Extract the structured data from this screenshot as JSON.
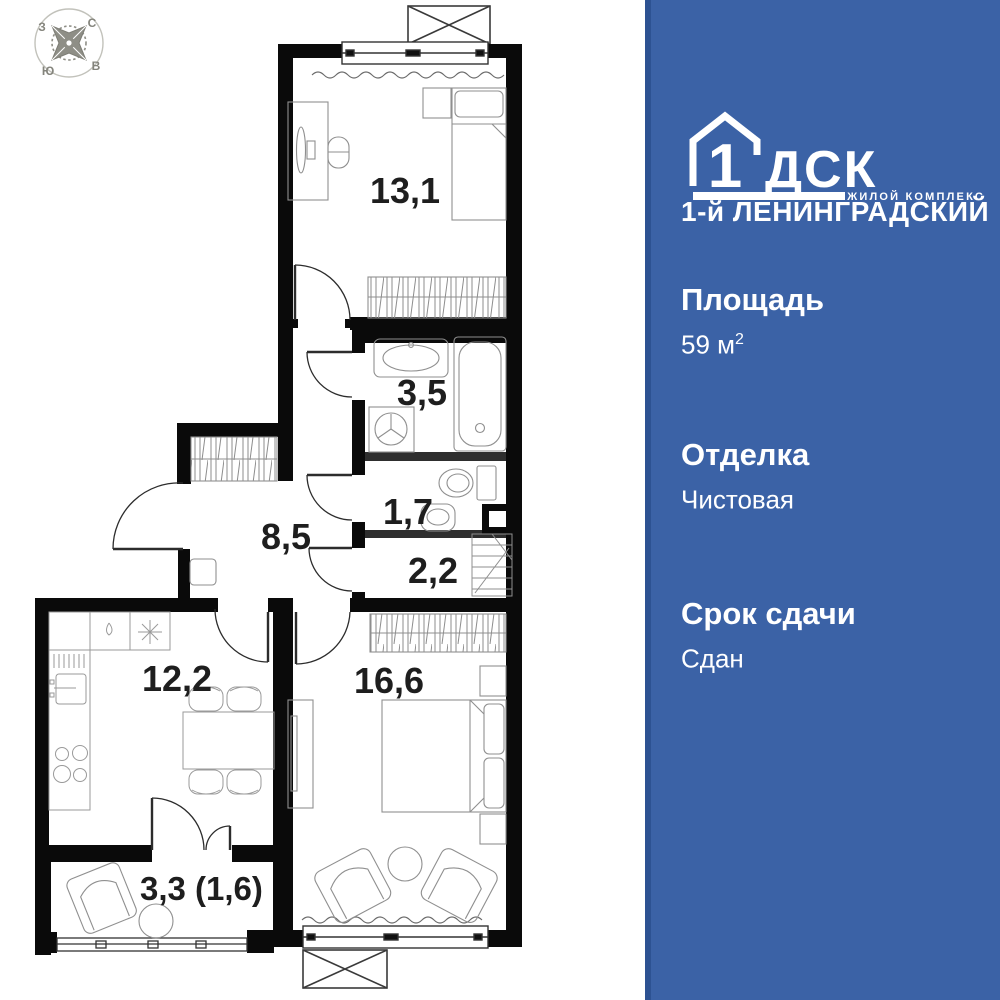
{
  "panel": {
    "brand": {
      "logo_number": "1",
      "logo_letters": "ДСК",
      "tagline": "ЖИЛОЙ КОМПЛЕКС",
      "complex_name": "1-й ЛЕНИНГРАДСКИЙ"
    },
    "stats": [
      {
        "label": "Площадь",
        "value": "59 м",
        "sup": "2"
      },
      {
        "label": "Отделка",
        "value": "Чистовая",
        "sup": ""
      },
      {
        "label": "Срок сдачи",
        "value": "Сдан",
        "sup": ""
      }
    ],
    "colors": {
      "background": "#3b62a6",
      "edge": "#2d5292",
      "text": "#ffffff"
    }
  },
  "plan": {
    "compass": {
      "north": "С",
      "south": "Ю",
      "west": "З",
      "east": "В"
    },
    "rooms": [
      {
        "name": "bedroom-top",
        "area": "13,1"
      },
      {
        "name": "bathroom",
        "area": "3,5"
      },
      {
        "name": "wc",
        "area": "1,7"
      },
      {
        "name": "storage",
        "area": "2,2"
      },
      {
        "name": "hall",
        "area": "8,5"
      },
      {
        "name": "kitchen",
        "area": "12,2"
      },
      {
        "name": "bedroom-main",
        "area": "16,6"
      },
      {
        "name": "balcony",
        "area": "3,3 (1,6)"
      }
    ]
  }
}
